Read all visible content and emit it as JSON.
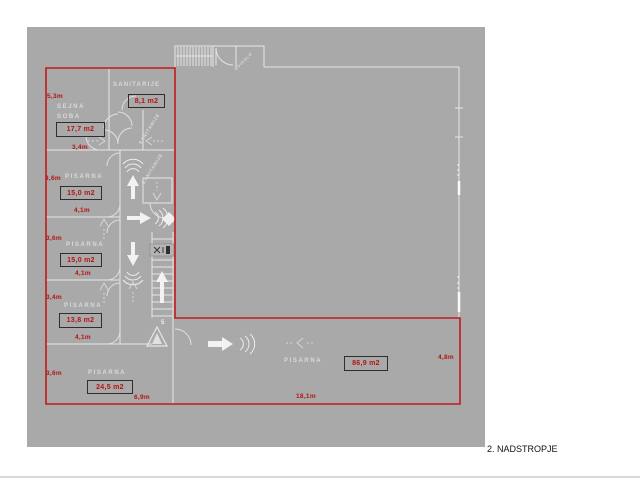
{
  "title": "2. NADSTROPJE",
  "colors": {
    "plan_background": "#a9a9a9",
    "outline_red": "#c21a1a",
    "wall_white": "#e6e6e6",
    "area_box_border": "#2e2e2e",
    "dimension_red": "#b51414",
    "room_label_gray": "#d9d9d9",
    "title_black": "#111111"
  },
  "rooms": [
    {
      "name": "SANITARIJE",
      "area": "8,1 m2"
    },
    {
      "line1": "SEJNA",
      "line2": "SOBA",
      "area": "17,7 m2",
      "dim_left": "5,3m",
      "dim_bottom": "3,4m"
    },
    {
      "name": "PISARNA",
      "area": "15,0 m2",
      "dim_left": "3,6m",
      "dim_bottom": "4,1m"
    },
    {
      "name": "PISARNA",
      "area": "15,0 m2",
      "dim_left": "3,6m",
      "dim_bottom": "4,1m"
    },
    {
      "name": "PISARNA",
      "area": "13,8 m2",
      "dim_left": "3,4m",
      "dim_bottom": "4,1m"
    },
    {
      "name": "PISARNA",
      "area": "24,5 m2",
      "dim_left": "3,6m",
      "dim_bottom": "6,9m"
    },
    {
      "name": "PISARNA",
      "area": "86,9 m2",
      "dim_right": "4,8m",
      "dim_bottom": "18,1m"
    }
  ],
  "annotations": {
    "elevator_label": "DVIGALO",
    "shaft_label_1": "SANITARIJE",
    "shaft_label_2": "SANITARIJE",
    "section_marker": "5"
  }
}
